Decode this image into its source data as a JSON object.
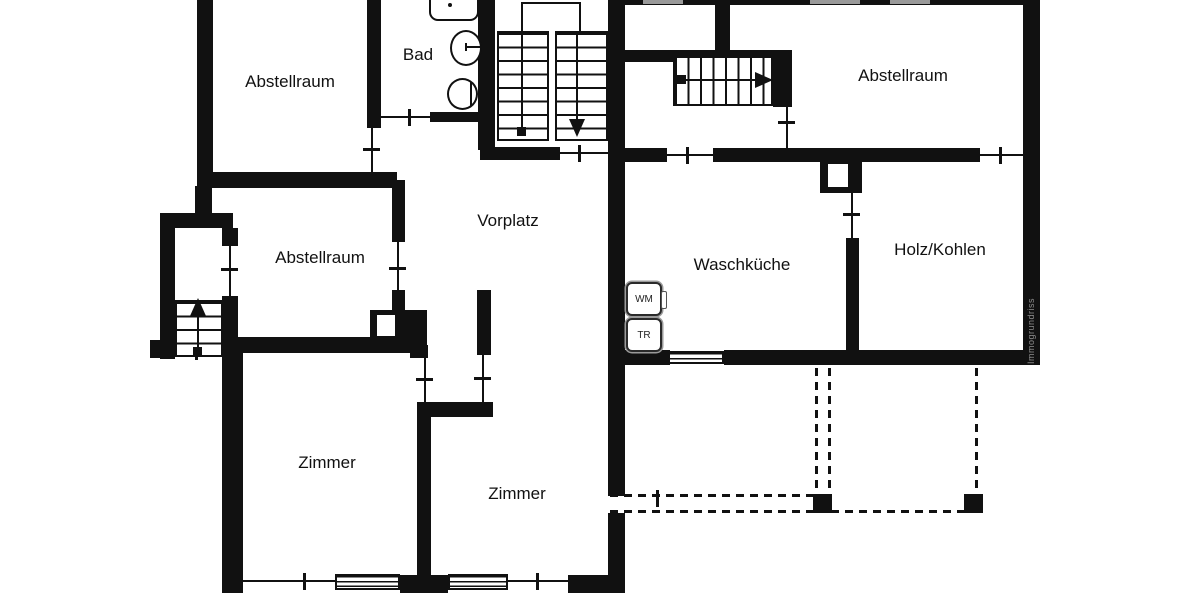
{
  "plan": {
    "title": "Untergeschoss Grundriss",
    "rooms": [
      {
        "id": "abstellraum-top-left",
        "label": "Abstellraum"
      },
      {
        "id": "bad",
        "label": "Bad"
      },
      {
        "id": "abstellraum-top-right",
        "label": "Abstellraum"
      },
      {
        "id": "abstellraum-middle",
        "label": "Abstellraum"
      },
      {
        "id": "vorplatz",
        "label": "Vorplatz"
      },
      {
        "id": "waschkueche",
        "label": "Waschküche"
      },
      {
        "id": "holz-kohlen",
        "label": "Holz/Kohlen"
      },
      {
        "id": "zimmer-left",
        "label": "Zimmer"
      },
      {
        "id": "zimmer-right",
        "label": "Zimmer"
      }
    ],
    "appliances": [
      {
        "id": "washing-machine",
        "label": "WM"
      },
      {
        "id": "dryer",
        "label": "TR"
      }
    ],
    "watermark": "Immogrundriss"
  },
  "colors": {
    "wall": "#111111",
    "background": "#ffffff",
    "window_gray": "#9a9a9a",
    "watermark_gray": "#8d8d8d"
  }
}
